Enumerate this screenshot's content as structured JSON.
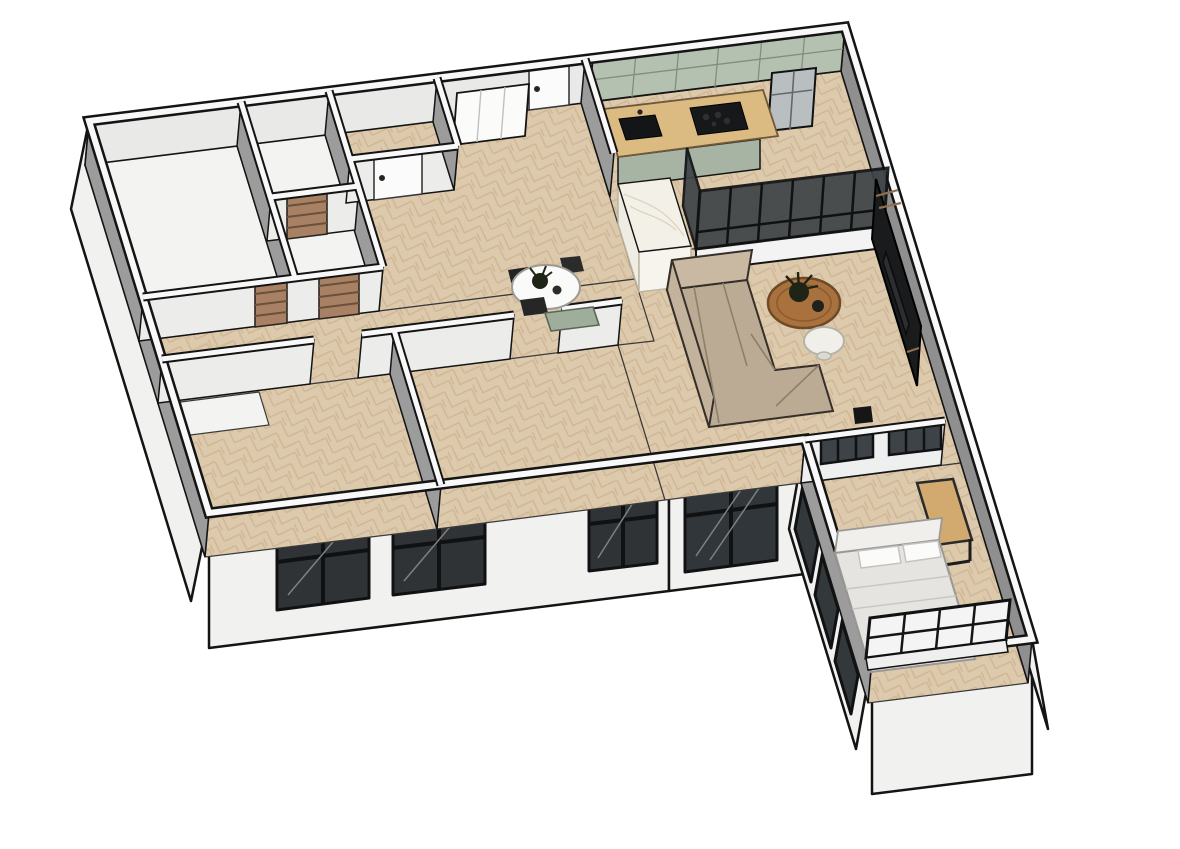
{
  "meta": {
    "description": "3D isometric cutaway render of an L-shaped apartment floor plan, SketchUp style, viewed from above.",
    "view": "axonometric bird's-eye",
    "background": "#ffffff"
  },
  "rooms": [
    {
      "name": "bathroom",
      "floor": "white"
    },
    {
      "name": "wc",
      "floor": "white"
    },
    {
      "name": "storage-lobby",
      "floor": "herringbone-wood"
    },
    {
      "name": "entry-corridor",
      "floor": "herringbone-wood"
    },
    {
      "name": "hallway",
      "floor": "herringbone-wood"
    },
    {
      "name": "bedroom-left-1",
      "floor": "herringbone-wood"
    },
    {
      "name": "bedroom-left-2",
      "floor": "herringbone-wood"
    },
    {
      "name": "kitchen",
      "floor": "herringbone-wood"
    },
    {
      "name": "living-room",
      "floor": "herringbone-wood"
    },
    {
      "name": "bedroom-wing",
      "floor": "herringbone-wood"
    }
  ],
  "furniture": [
    "entry-wardrobes",
    "white-interior-doors",
    "wood-slatted-doors",
    "kitchen-upper-and-base-cabinets",
    "wood-countertop",
    "black-cooktop",
    "black-sink",
    "stainless-fridge",
    "marble-island",
    "black-frame-glass-partition",
    "dining-table-with-chairs",
    "green-sideboard",
    "l-shaped-sofa",
    "round-wood-coffee-table",
    "plant",
    "white-side-table",
    "black-tv-media-wall",
    "desk",
    "double-bed-with-pillows",
    "open-shelf-unit",
    "black-framed-windows",
    "glazed-sliding-door",
    "interior-transom-windows"
  ],
  "counts": {
    "exterior_windows": 3,
    "glazed_door_panels": 1,
    "wing_glazing_panels": 3,
    "wood_doors": 3,
    "white_doors": 2,
    "interior_windows": 2
  },
  "colors": {
    "outline": "#141414",
    "band_white": "#f8f8f8",
    "face_light": "#e9e9e8",
    "face_gray": "#9c9c9c",
    "face_gray_dark": "#8f8f8f",
    "exterior": "#f1f1f0",
    "floor_base": "#ddc9ab",
    "floor_stripe": "#c9b08e",
    "floor_white": "#f3f3f1",
    "sage_cabinet": "#b5c1b0",
    "sage_base": "#a7b4a3",
    "counter_wood": "#dcbb83",
    "appliance_black": "#17181a",
    "steel": "#b9bec1",
    "marble": "#f3f0e8",
    "glass_dark": "#3d4347",
    "frame_black": "#101112",
    "window_glass": "#2f3336",
    "sofa": "#bcab94",
    "sofa_back": "#c9b9a3",
    "coffee_table_wood": "#a9713d",
    "pouf_white": "#f1efe9",
    "sideboard_green": "#9fae9a",
    "door_wood": "#a88164",
    "door_slat": "#6b4f39",
    "door_white": "#fbfbfb",
    "tv_black": "#1a1b1d",
    "duvet": "#e6e4e1",
    "pillow": "#fbfbfa",
    "shelf_white": "#f4f4f4",
    "desk_wood": "#d2a96f",
    "table_white": "#fafaf8",
    "plant_dark": "#1e2416"
  }
}
